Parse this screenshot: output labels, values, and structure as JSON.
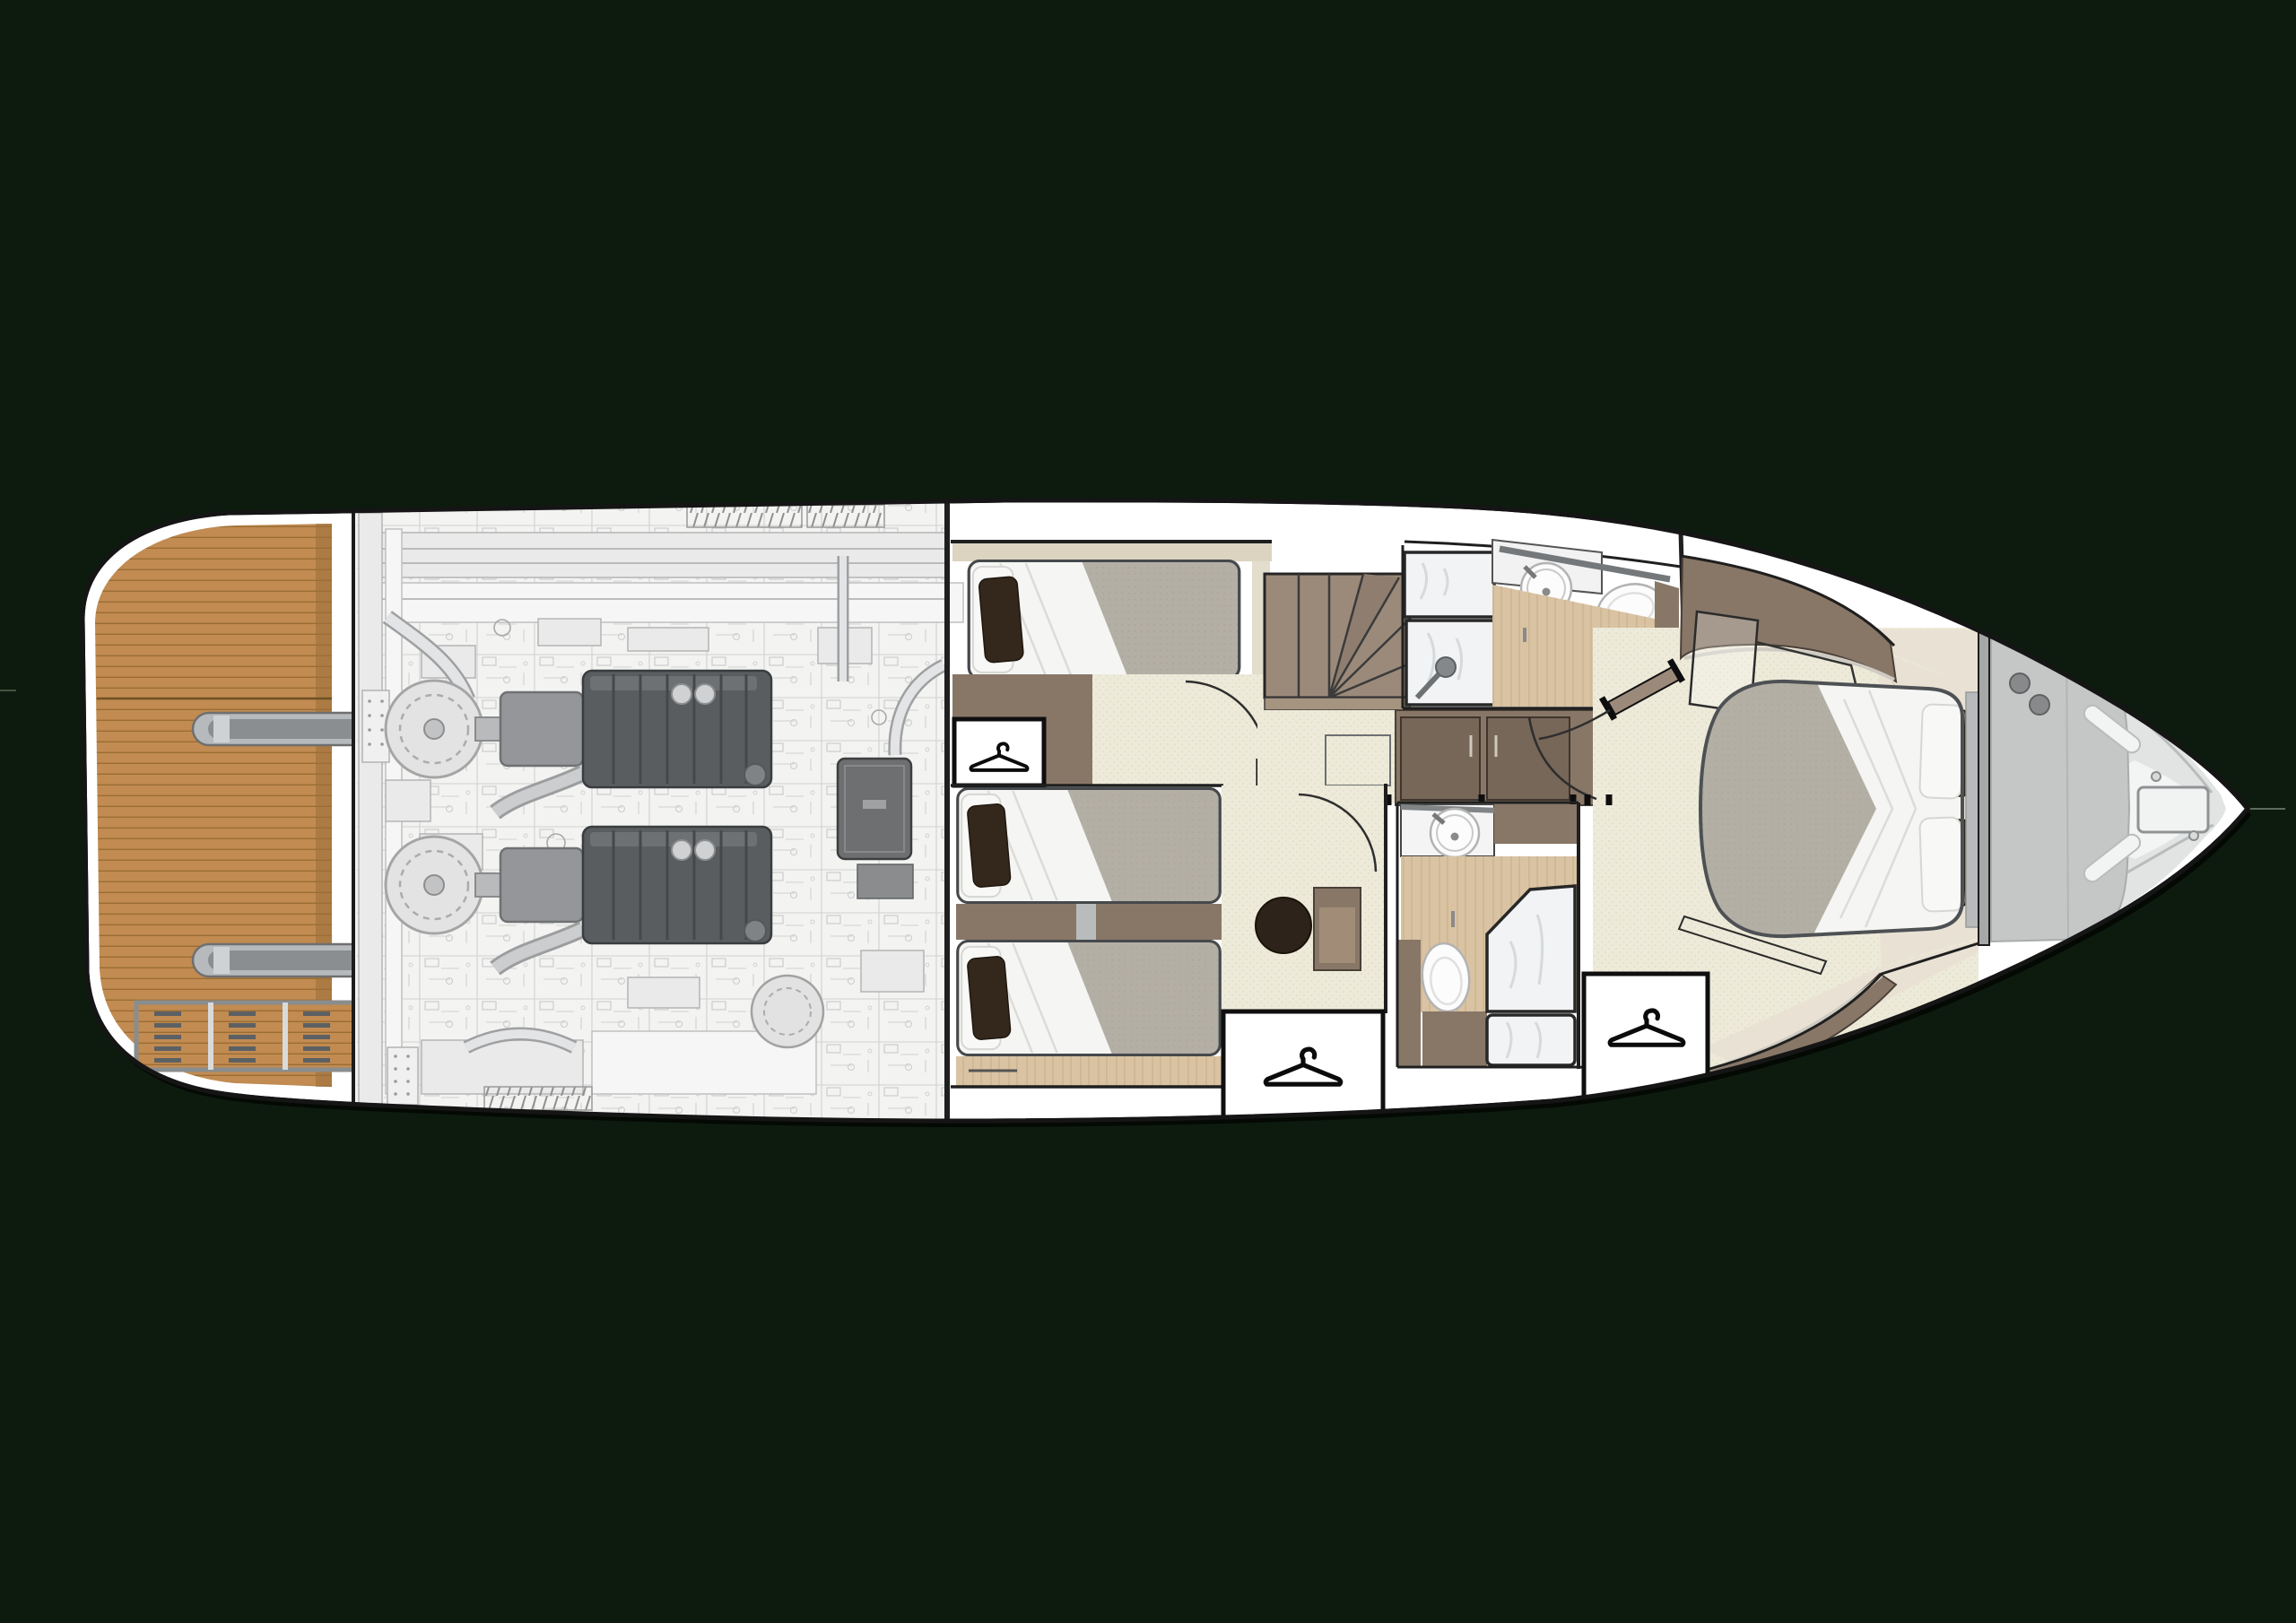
{
  "diagram": {
    "type": "yacht-lower-deck-floor-plan",
    "orientation": "bow-right-stern-left",
    "visible_elements": {
      "swim_platform_with_teak_deck": true,
      "platform_recess_hatch": 1,
      "platform_steps": 2,
      "transom_vent_grid_cells": 5,
      "engine_room_engines": 2,
      "cabins": 3,
      "beds_mid_single": 3,
      "bed_master_double": 1,
      "staircase": 1,
      "bathrooms": 2,
      "sinks": 2,
      "toilets": 2,
      "showers": 2,
      "closets_with_hanger_icon": 3,
      "round_pouf": 1,
      "foredeck_sunpad": 1,
      "anchor_hatch": 1
    },
    "icons": [
      {
        "name": "clothes-hanger-icon",
        "count": 3,
        "style": "black outline on white panel"
      }
    ]
  },
  "palette": {
    "bg": "#0d1b0e",
    "hull": "#ffffff",
    "outline": "#151515",
    "teak": "#c18b51",
    "teak-line": "#93682f",
    "teak-edge": "#9b7038",
    "eng-bg": "#f3f3f2",
    "eng-dark": "#5a5d5f",
    "wall": "#887767",
    "door": "#776759",
    "beige": "#dcd4c1",
    "carpet": "#edead9",
    "carpet-dot": "#dfdbc6",
    "wood": "#d9c3a3",
    "wood-grain": "#c7ae88",
    "marble": "#e9e2d4",
    "mattress": "#b4afa5",
    "mattress-dot": "#a7a298",
    "duvet": "#f5f5f3",
    "pillow-dark": "#34281d",
    "fixture": "#fcfcfc",
    "fixture-line": "#b3b3b3",
    "glass": "#f1f3f4",
    "streak": "#d3d7da",
    "deck": "#e2e3e3",
    "deck-light": "#f3f4f4",
    "sunpad": "#c5c6c6",
    "pouf": "#2d231a"
  }
}
